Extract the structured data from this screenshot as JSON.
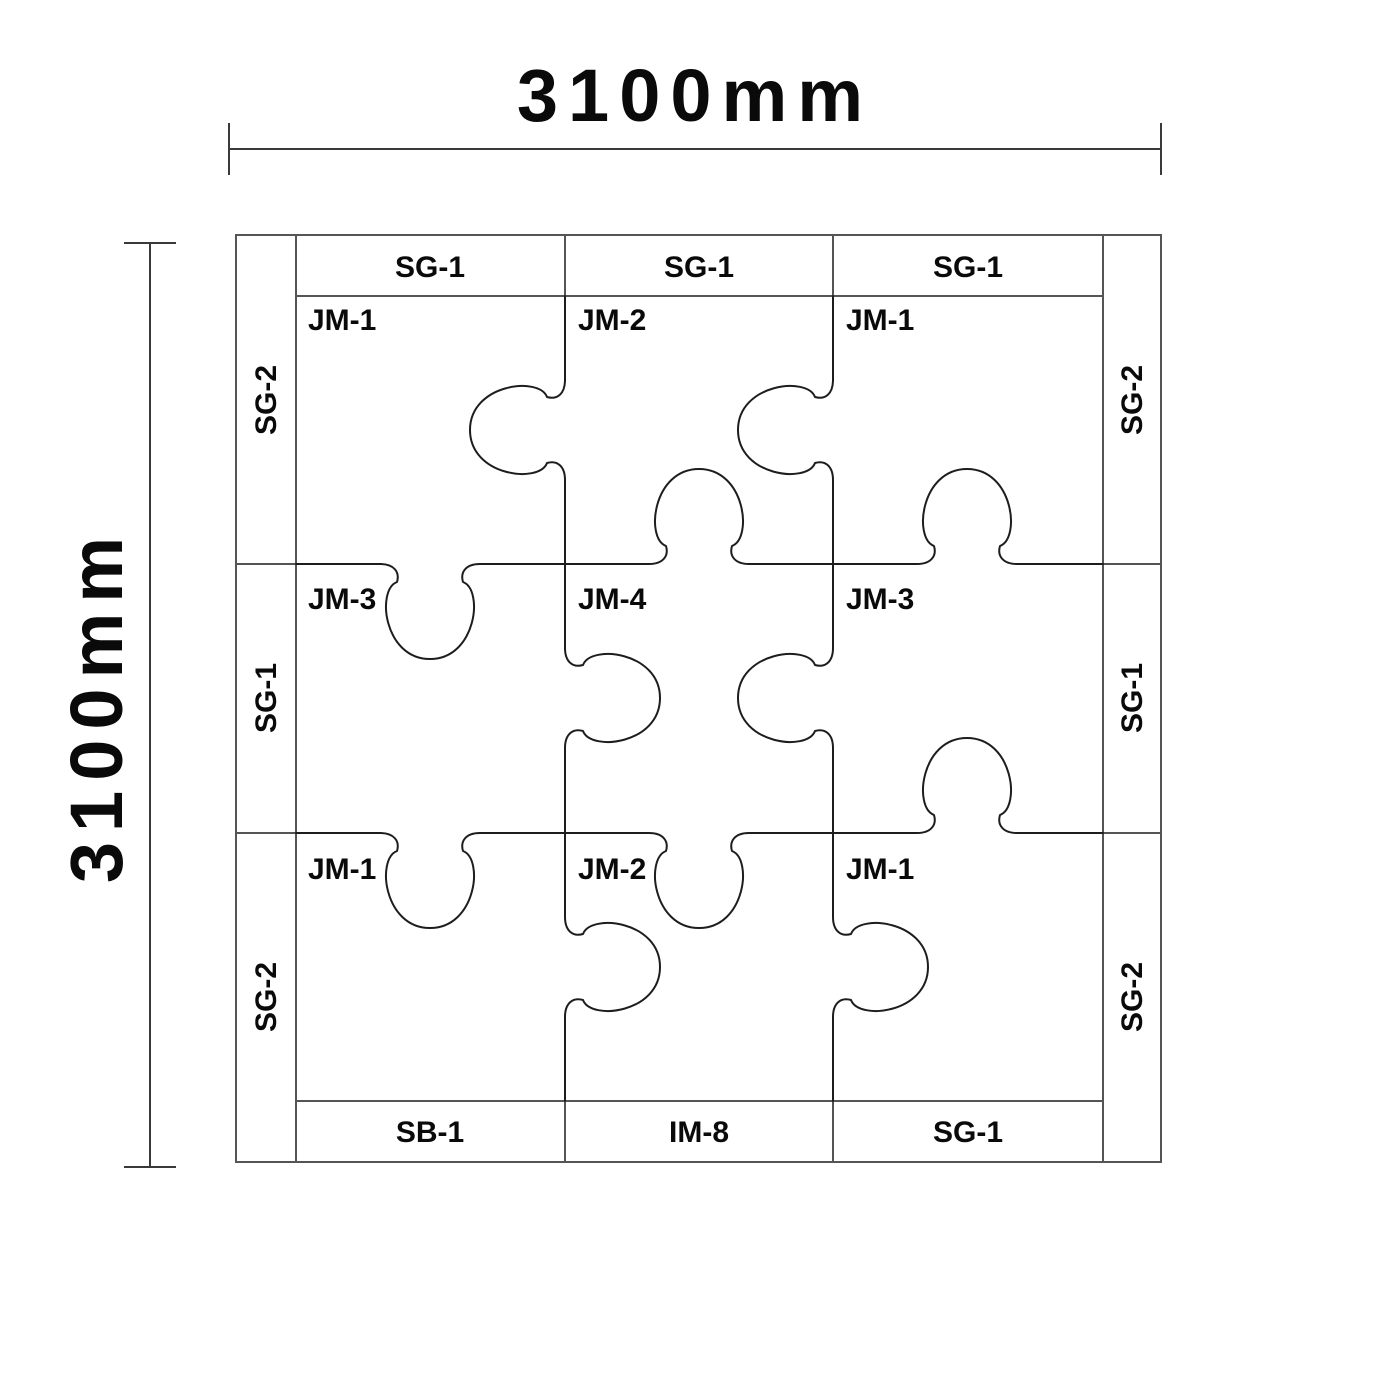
{
  "dimensions": {
    "width_label": "3100mm",
    "height_label": "3100mm"
  },
  "strips": {
    "top": [
      "SG-1",
      "SG-1",
      "SG-1"
    ],
    "bottom": [
      "SB-1",
      "IM-8",
      "SG-1"
    ],
    "left": [
      "SG-2",
      "SG-1",
      "SG-2"
    ],
    "right": [
      "SG-2",
      "SG-1",
      "SG-2"
    ]
  },
  "pieces": [
    [
      "JM-1",
      "JM-2",
      "JM-1"
    ],
    [
      "JM-3",
      "JM-4",
      "JM-3"
    ],
    [
      "JM-1",
      "JM-2",
      "JM-1"
    ]
  ],
  "puzzle": {
    "vertical_boundaries": [
      {
        "x": 565,
        "y0": 296,
        "y1": 1101,
        "tabs": [
          {
            "at": 430,
            "dir": "left"
          },
          {
            "at": 698,
            "dir": "right"
          },
          {
            "at": 967,
            "dir": "right"
          }
        ]
      },
      {
        "x": 833,
        "y0": 296,
        "y1": 1101,
        "tabs": [
          {
            "at": 430,
            "dir": "left"
          },
          {
            "at": 698,
            "dir": "left"
          },
          {
            "at": 967,
            "dir": "right"
          }
        ]
      }
    ],
    "horizontal_boundaries": [
      {
        "y": 564,
        "x0": 296,
        "x1": 1103,
        "tabs": [
          {
            "at": 430,
            "dir": "down"
          },
          {
            "at": 699,
            "dir": "up"
          },
          {
            "at": 967,
            "dir": "up"
          }
        ]
      },
      {
        "y": 833,
        "x0": 296,
        "x1": 1103,
        "tabs": [
          {
            "at": 430,
            "dir": "down"
          },
          {
            "at": 699,
            "dir": "down"
          },
          {
            "at": 967,
            "dir": "up"
          }
        ]
      }
    ],
    "tab_shape": {
      "half_gap": 50,
      "reach": 95,
      "bulge": 46
    }
  },
  "colors": {
    "background": "#ffffff",
    "frame_line": "#555555",
    "puzzle_line": "#1d1d1d",
    "dimension_line": "#3a3a3a",
    "text": "#0a0a0a"
  }
}
